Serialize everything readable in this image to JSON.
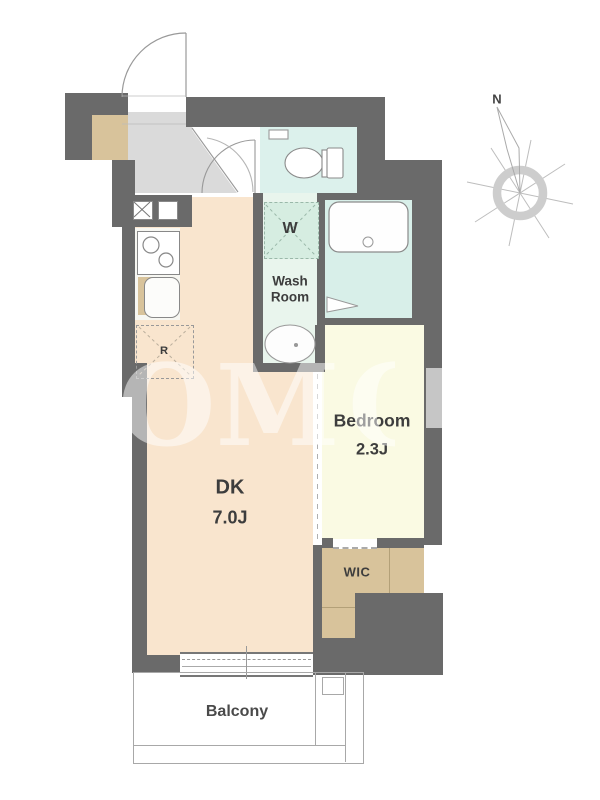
{
  "floorplan": {
    "compass": {
      "north_label": "N"
    },
    "rooms": {
      "dk": {
        "name": "DK",
        "size": "7.0J"
      },
      "bedroom": {
        "name": "Bedroom",
        "size": "2.3J"
      },
      "washroom": {
        "line1": "Wash",
        "line2": "Room"
      },
      "wic": {
        "name": "WIC"
      },
      "balcony": {
        "name": "Balcony"
      }
    },
    "fixtures": {
      "washer_space_label": "W",
      "refrigerator_space_label": "R"
    },
    "watermark": {
      "text": "OM",
      "partial_letter": "O"
    },
    "colors": {
      "wall": "#6a6a6a",
      "dk_floor": "#f9e5ce",
      "bedroom_floor": "#fafae3",
      "bathroom_floor": "#d8efe9",
      "toilet_floor": "#dcf1ec",
      "washroom_floor": "#e9f5ed",
      "washer_space": "#d6ede1",
      "closet": "#d8c39b",
      "entrance_floor": "#dadada",
      "label_text": "#3d3d3d"
    }
  }
}
